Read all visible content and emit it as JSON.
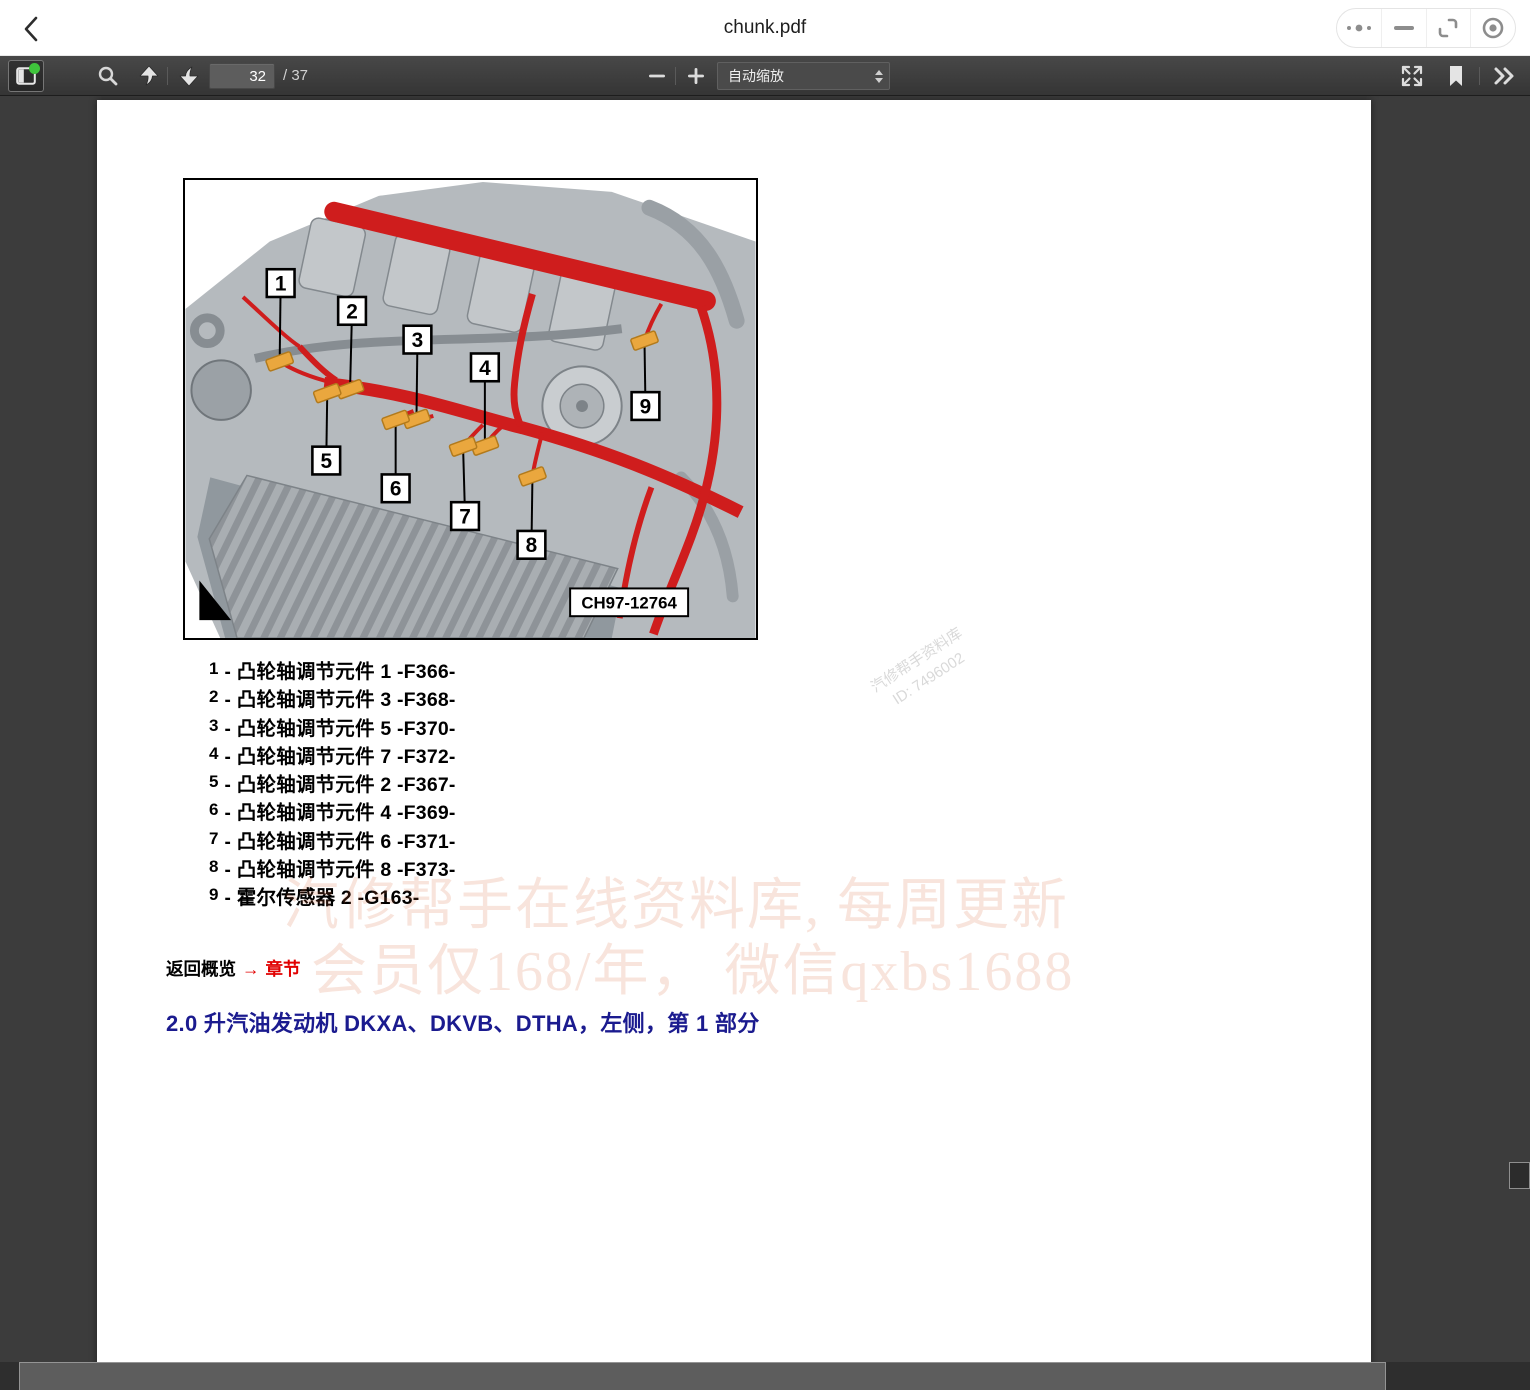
{
  "window": {
    "title": "chunk.pdf"
  },
  "toolbar": {
    "page_input": "32",
    "page_count": "/ 37",
    "zoom_value": "自动缩放"
  },
  "page": {
    "figure": {
      "callouts": [
        "1",
        "2",
        "3",
        "4",
        "5",
        "6",
        "7",
        "8",
        "9"
      ],
      "code": "CH97-12764"
    },
    "legend_separator": "-",
    "legend": [
      {
        "num": "1",
        "text": "凸轮轴调节元件 1 -F366-"
      },
      {
        "num": "2",
        "text": "凸轮轴调节元件 3 -F368-"
      },
      {
        "num": "3",
        "text": "凸轮轴调节元件 5 -F370-"
      },
      {
        "num": "4",
        "text": "凸轮轴调节元件 7 -F372-"
      },
      {
        "num": "5",
        "text": "凸轮轴调节元件 2 -F367-"
      },
      {
        "num": "6",
        "text": "凸轮轴调节元件 4 -F369-"
      },
      {
        "num": "7",
        "text": "凸轮轴调节元件 6 -F371-"
      },
      {
        "num": "8",
        "text": "凸轮轴调节元件 8 -F373-"
      },
      {
        "num": "9",
        "text": "霍尔传感器 2 -G163-"
      }
    ],
    "back_link": {
      "label": "返回概览",
      "arrow": "→",
      "target": "章节"
    },
    "heading": "2.0 升汽油发动机 DKXA、DKVB、DTHA，左侧，第 1 部分",
    "watermark": {
      "diagonal_line1": "汽修帮手资料库",
      "diagonal_line2": "ID: 7496002",
      "big_line1": "汽修帮手在线资料库, 每周更新",
      "big_line2": "会员仅168/年， 微信qxbs1688"
    }
  },
  "colors": {
    "harness_red": "#cf1d1d",
    "connector_yellow": "#eaa73e",
    "heading_blue": "#1b1b8f",
    "link_red": "#e10000",
    "toolbar_bg": "#3f3f3f",
    "viewer_bg": "#3c3c3c"
  }
}
